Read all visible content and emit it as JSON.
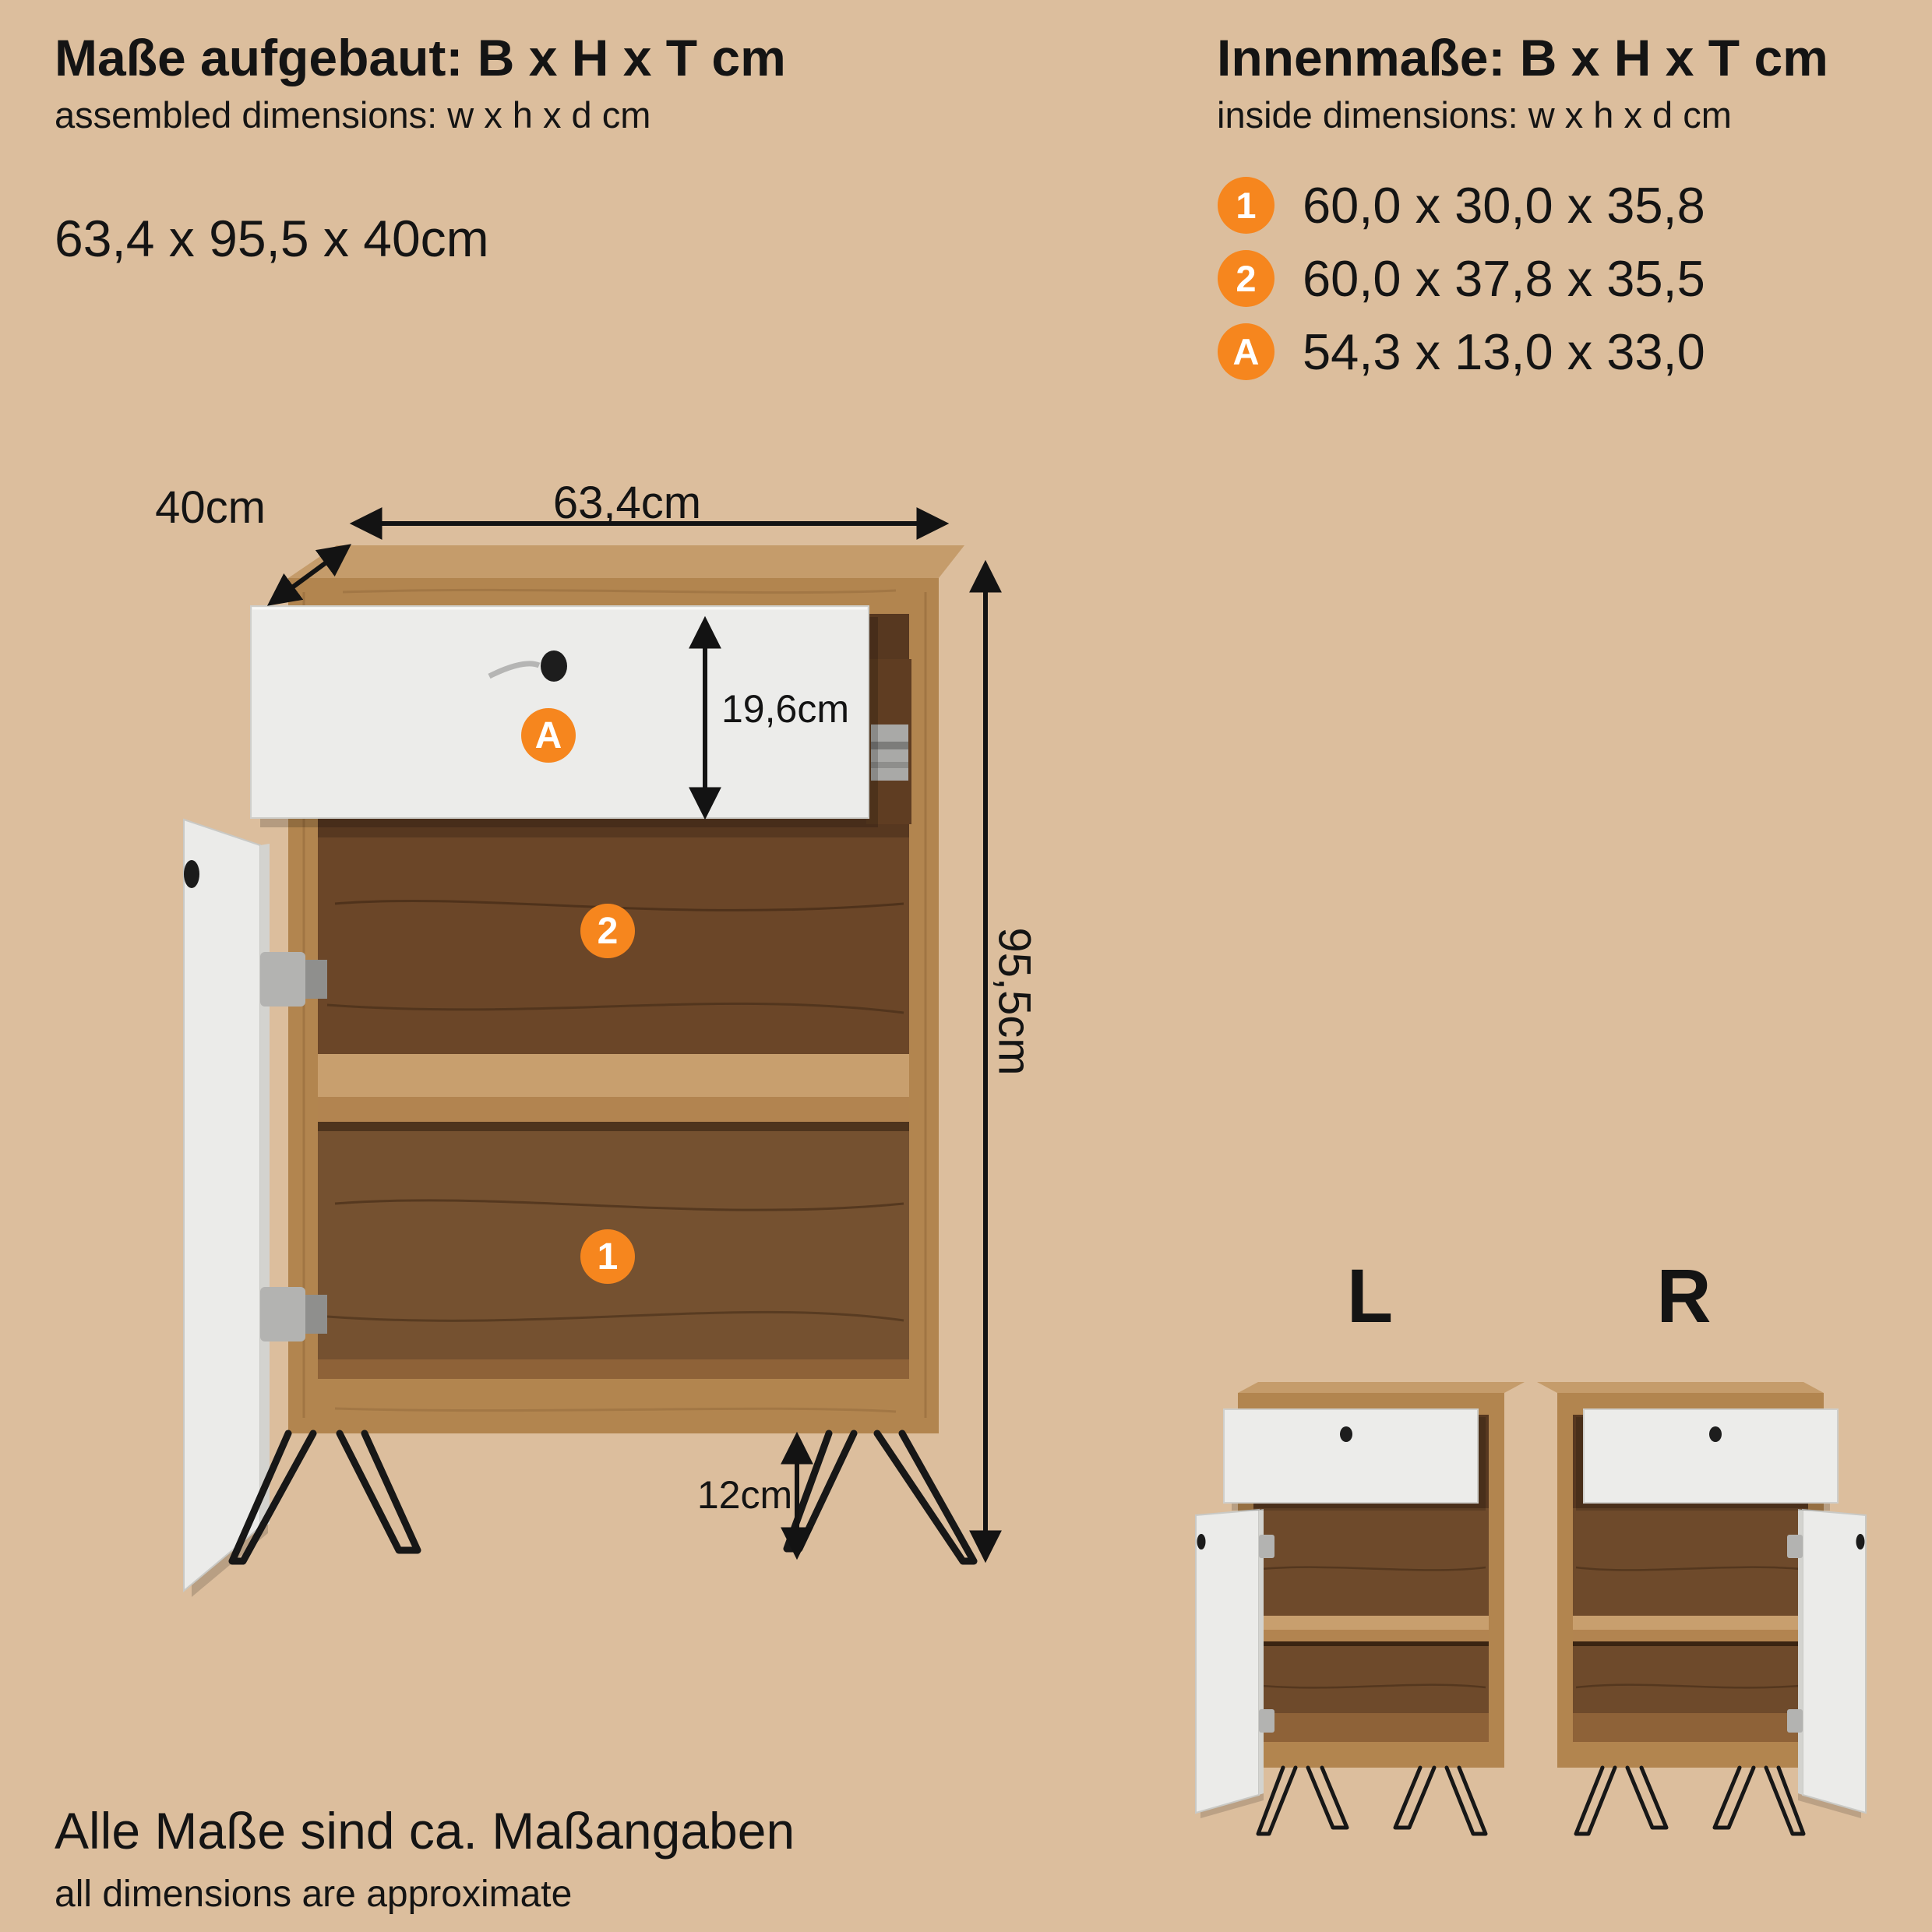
{
  "colors": {
    "background": "#dcbe9d",
    "accent": "#f6861e",
    "text": "#141414",
    "wood_frame": "#b2854f",
    "wood_top": "#c59c6b",
    "wood_interior": "#6e4a2b",
    "front_white": "#ececea"
  },
  "header_left": {
    "title": "Maße aufgebaut: B x H x T cm",
    "subtitle": "assembled dimensions: w x h x d cm",
    "dimensions": "63,4 x 95,5 x 40cm"
  },
  "header_right": {
    "title": "Innenmaße: B x H x T cm",
    "subtitle": "inside dimensions: w x h x d cm",
    "items": [
      {
        "badge": "1",
        "text": "60,0 x 30,0 x 35,8"
      },
      {
        "badge": "2",
        "text": "60,0 x 37,8 x 35,5"
      },
      {
        "badge": "A",
        "text": "54,3 x 13,0 x 33,0"
      }
    ]
  },
  "diagram": {
    "width_label": "63,4cm",
    "depth_label": "40cm",
    "height_label": "95,5cm",
    "drawer_height_label": "19,6cm",
    "leg_height_label": "12cm",
    "badges": {
      "drawer": "A",
      "middle": "2",
      "bottom": "1"
    }
  },
  "variants": {
    "left": "L",
    "right": "R"
  },
  "footer": {
    "line1": "Alle Maße sind ca. Maßangaben",
    "line2": "all dimensions are approximate"
  }
}
